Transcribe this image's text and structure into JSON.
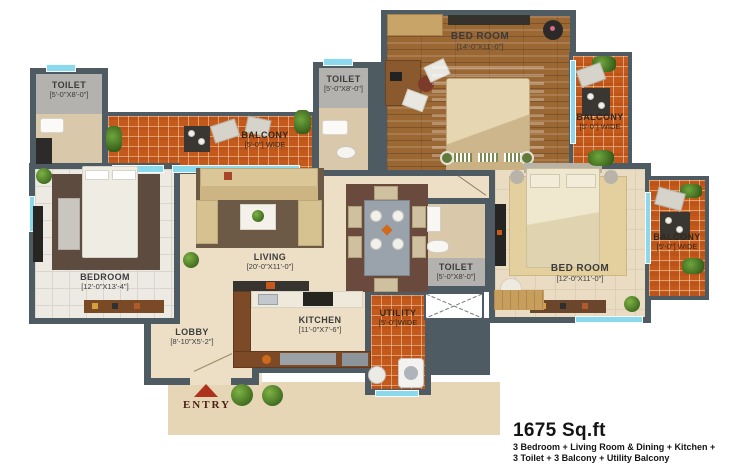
{
  "plan_title": "apartment-floor-plan",
  "rooms": [
    {
      "id": "toilet-top-left",
      "name": "TOILET",
      "dims": "[5'-0\"X8'-0\"]"
    },
    {
      "id": "balcony-top",
      "name": "BALCONY",
      "dims": "[5'-0\"] WIDE"
    },
    {
      "id": "toilet-top-middle",
      "name": "TOILET",
      "dims": "[5'-0\"X8'-0\"]"
    },
    {
      "id": "bedroom-top",
      "name": "BED ROOM",
      "dims": "[14'-0\"X11'-0\"]"
    },
    {
      "id": "balcony-top-right",
      "name": "BALCONY",
      "dims": "[5'-0\"] WIDE"
    },
    {
      "id": "bedroom-left",
      "name": "BEDROOM",
      "dims": "[12'-0\"X13'-4\"]"
    },
    {
      "id": "living",
      "name": "LIVING",
      "dims": "[20'-0\"X11'-0\"]"
    },
    {
      "id": "toilet-middle",
      "name": "TOILET",
      "dims": "[5'-0\"X8'-0\"]"
    },
    {
      "id": "bedroom-right",
      "name": "BED ROOM",
      "dims": "[12'-0\"X11'-0\"]"
    },
    {
      "id": "balcony-right",
      "name": "BALCONY",
      "dims": "[5'-0\"] WIDE"
    },
    {
      "id": "kitchen",
      "name": "KITCHEN",
      "dims": "[11'-0\"X7'-6\"]"
    },
    {
      "id": "lobby",
      "name": "LOBBY",
      "dims": "[8'-10\"X5'-2\"]"
    },
    {
      "id": "utility",
      "name": "UTILITY",
      "dims": "[5'-0\"]WIDE"
    }
  ],
  "entry": {
    "label": "ENTRY"
  },
  "summary": {
    "area": "1675 Sq.ft",
    "line1": "3 Bedroom + Living Room & Dining + Kitchen +",
    "line2": "3 Toilet + 3 Balcony + Utility Balcony"
  },
  "colors": {
    "wall": "#4e5b62",
    "balcony_tile": "#c3591b",
    "window": "#8bd9ec",
    "interior_floor": "#ecdfc6",
    "wood_floor": "#9b6733",
    "entry_arrow": "#ad331d"
  }
}
